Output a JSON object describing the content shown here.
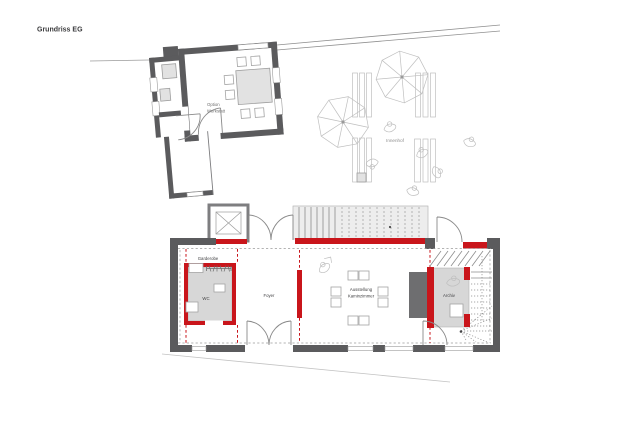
{
  "title": "Grundriss EG",
  "colors": {
    "wall": "#5b5b5d",
    "accent": "#c9151b",
    "room_fill": "#d7d7d7",
    "fireplace": "#6e6e70",
    "stair_fill": "#ededed",
    "sketch": "#bfbfbf",
    "label": "#3f3f41",
    "muted_label": "#8f8f8f"
  },
  "rooms": {
    "garderobe": "Garderobe",
    "wc": "WC",
    "foyer": "Foyer",
    "ausstellung_line1": "Ausstellung",
    "ausstellung_line2": "Kaminzimmer",
    "archiv": "Archiv",
    "option_line1": "Option",
    "option_line2": "Werkstatt"
  },
  "site": {
    "innenhof": "Innenhof"
  }
}
